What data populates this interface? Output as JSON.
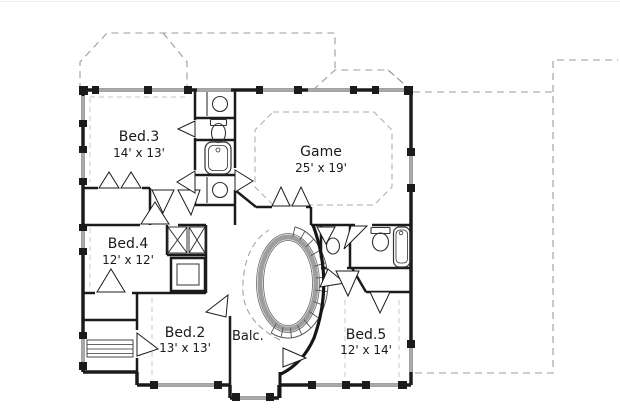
{
  "plan": {
    "type": "floor-plan",
    "rooms": [
      {
        "name": "Bed.3",
        "dims": "14' x 13'"
      },
      {
        "name": "Game",
        "dims": "25' x 19'"
      },
      {
        "name": "Bed.4",
        "dims": "12' x 12'"
      },
      {
        "name": "Bed.2",
        "dims": "13' x 13'"
      },
      {
        "name": "Bed.5",
        "dims": "12' x 14'"
      },
      {
        "name": "Balc."
      }
    ],
    "colors": {
      "wall": "#1b1b1b",
      "window": "#a9a9a9",
      "roof_dash": "#9b9b9b",
      "ceiling_dash": "#aaaaaa",
      "text": "#1a1a1a",
      "background": "#ffffff"
    }
  }
}
